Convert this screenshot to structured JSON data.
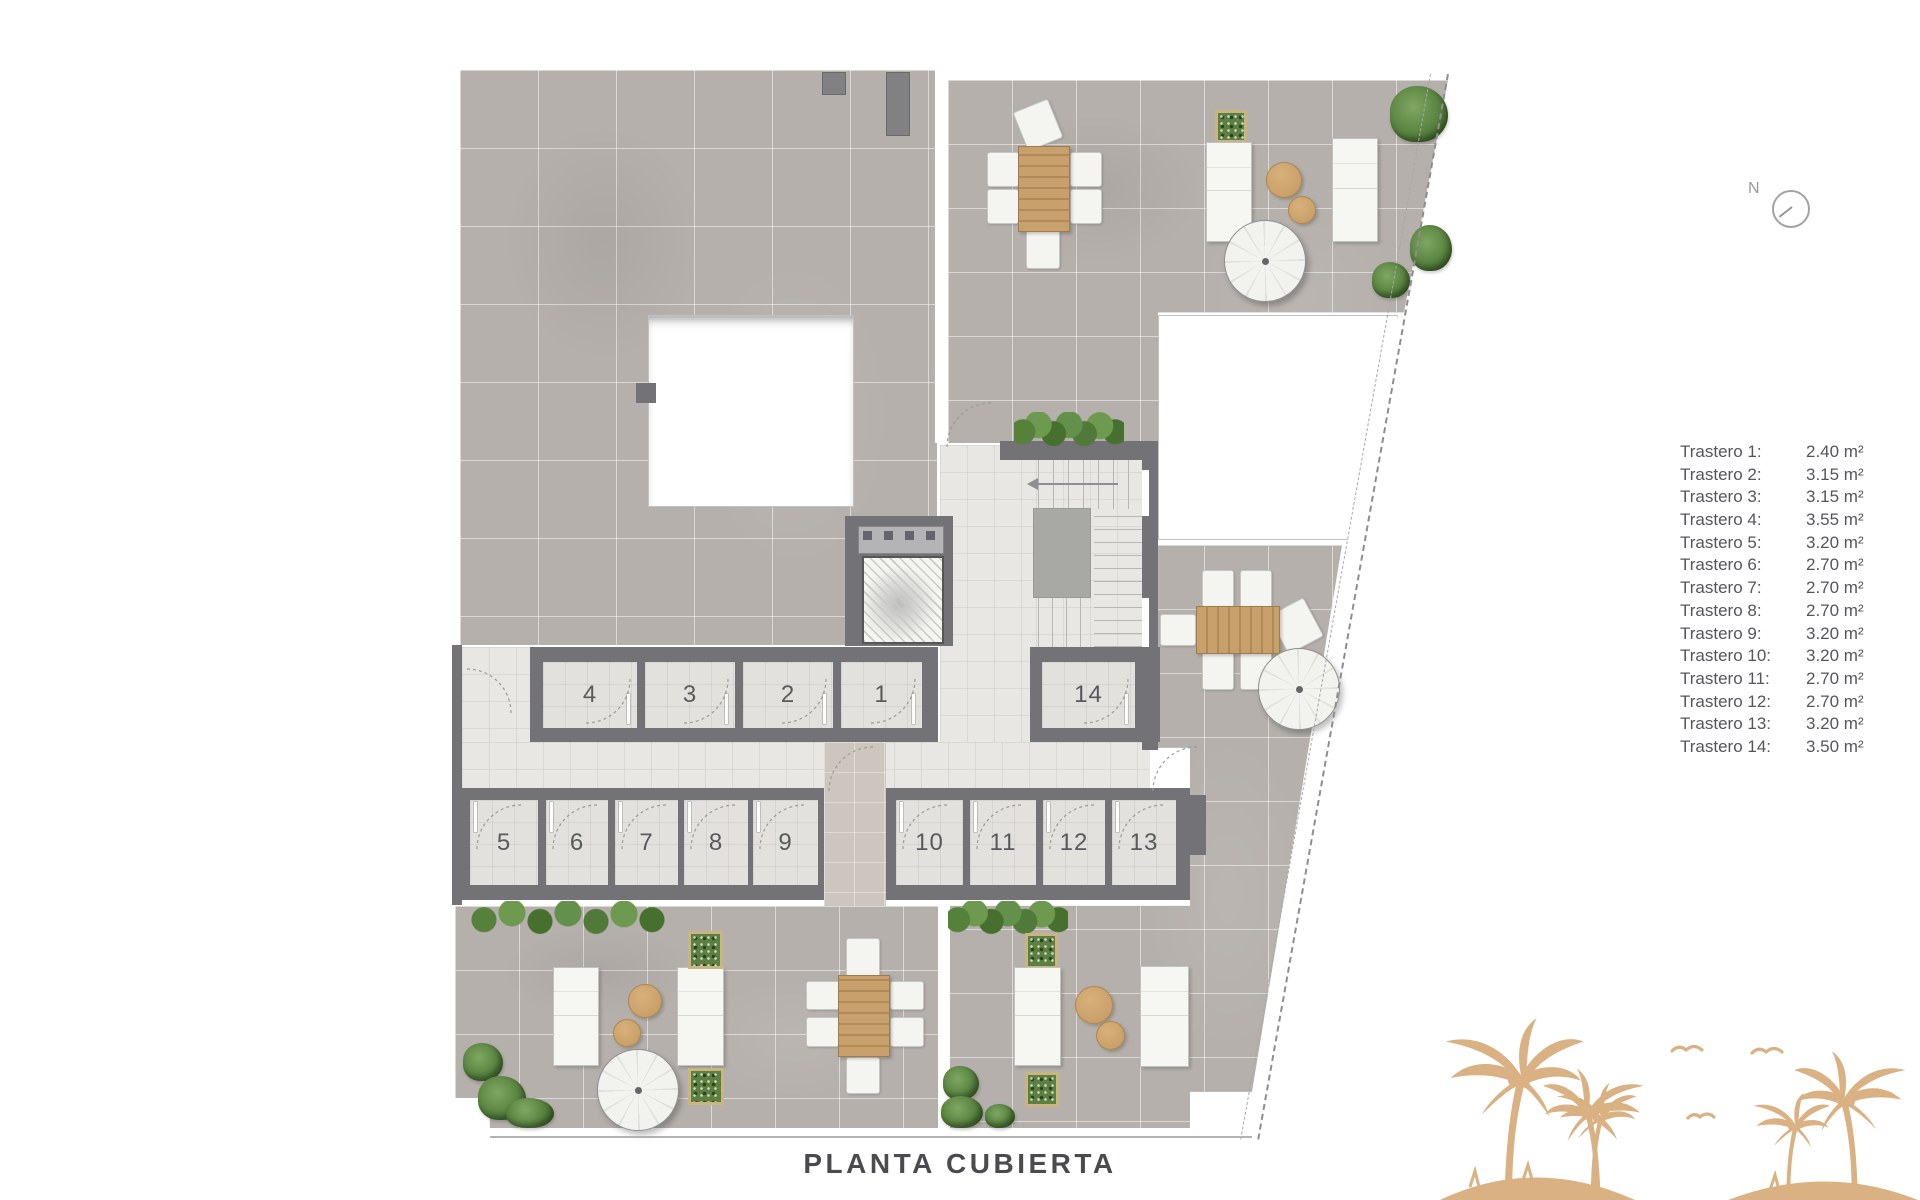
{
  "title": "PLANTA CUBIERTA",
  "compass": {
    "label": "N"
  },
  "legend": [
    {
      "label": "Trastero 1:",
      "value": "2.40 m²"
    },
    {
      "label": "Trastero 2:",
      "value": "3.15 m²"
    },
    {
      "label": "Trastero 3:",
      "value": "3.15 m²"
    },
    {
      "label": "Trastero 4:",
      "value": "3.55 m²"
    },
    {
      "label": "Trastero 5:",
      "value": "3.20 m²"
    },
    {
      "label": "Trastero 6:",
      "value": "2.70 m²"
    },
    {
      "label": "Trastero 7:",
      "value": "2.70 m²"
    },
    {
      "label": "Trastero 8:",
      "value": "2.70 m²"
    },
    {
      "label": "Trastero 9:",
      "value": "3.20 m²"
    },
    {
      "label": "Trastero 10:",
      "value": "3.20 m²"
    },
    {
      "label": "Trastero 11:",
      "value": "2.70 m²"
    },
    {
      "label": "Trastero 12:",
      "value": "2.70 m²"
    },
    {
      "label": "Trastero 13:",
      "value": "3.20 m²"
    },
    {
      "label": "Trastero 14:",
      "value": "3.50 m²"
    }
  ],
  "rooms": {
    "numbers": [
      "4",
      "3",
      "2",
      "1",
      "14",
      "5",
      "6",
      "7",
      "8",
      "9",
      "10",
      "11",
      "12",
      "13"
    ]
  },
  "colors": {
    "wall": "#737377",
    "terrace_tile": "#b5b0ab",
    "floor_light": "#e8e7e4",
    "greenery": "#4c7734",
    "wood": "#c7a06b",
    "palm_tan": "#d9b183",
    "legend_text": "#55565a",
    "title_text": "#4a4b4f"
  }
}
